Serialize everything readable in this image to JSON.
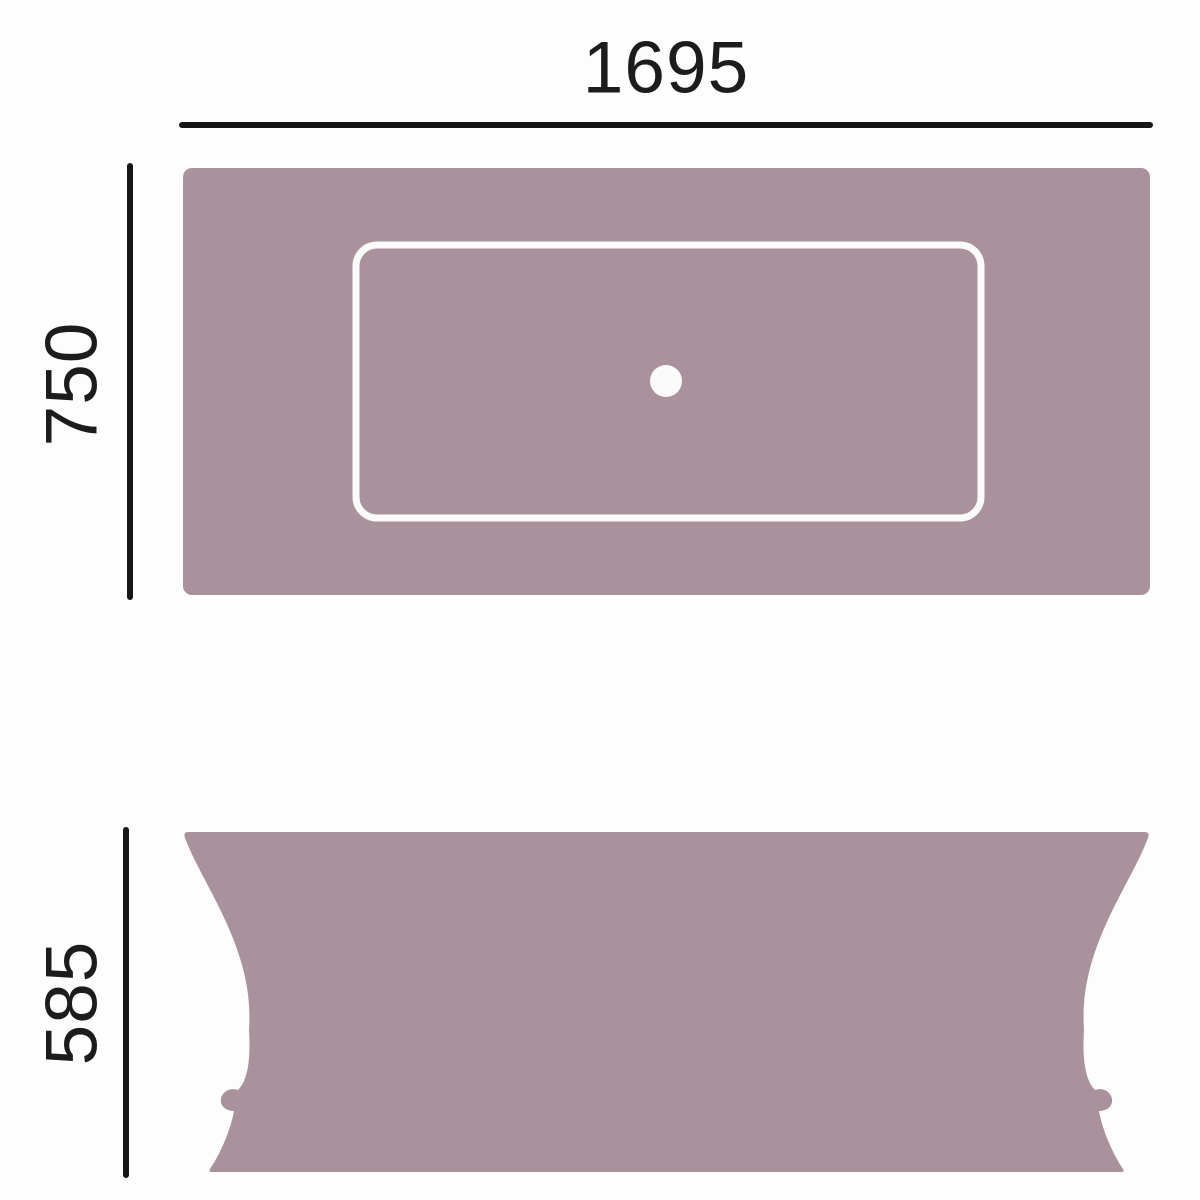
{
  "page": {
    "background": "#fdfdfd"
  },
  "diagram": {
    "labels": {
      "top_width": "1695",
      "top_depth": "750",
      "side_height": "585"
    },
    "colors": {
      "body_fill": "#aa929c",
      "white_detail": "#fbfafb",
      "dimension_line": "#161616",
      "label_text": "#1c1c1c"
    }
  }
}
